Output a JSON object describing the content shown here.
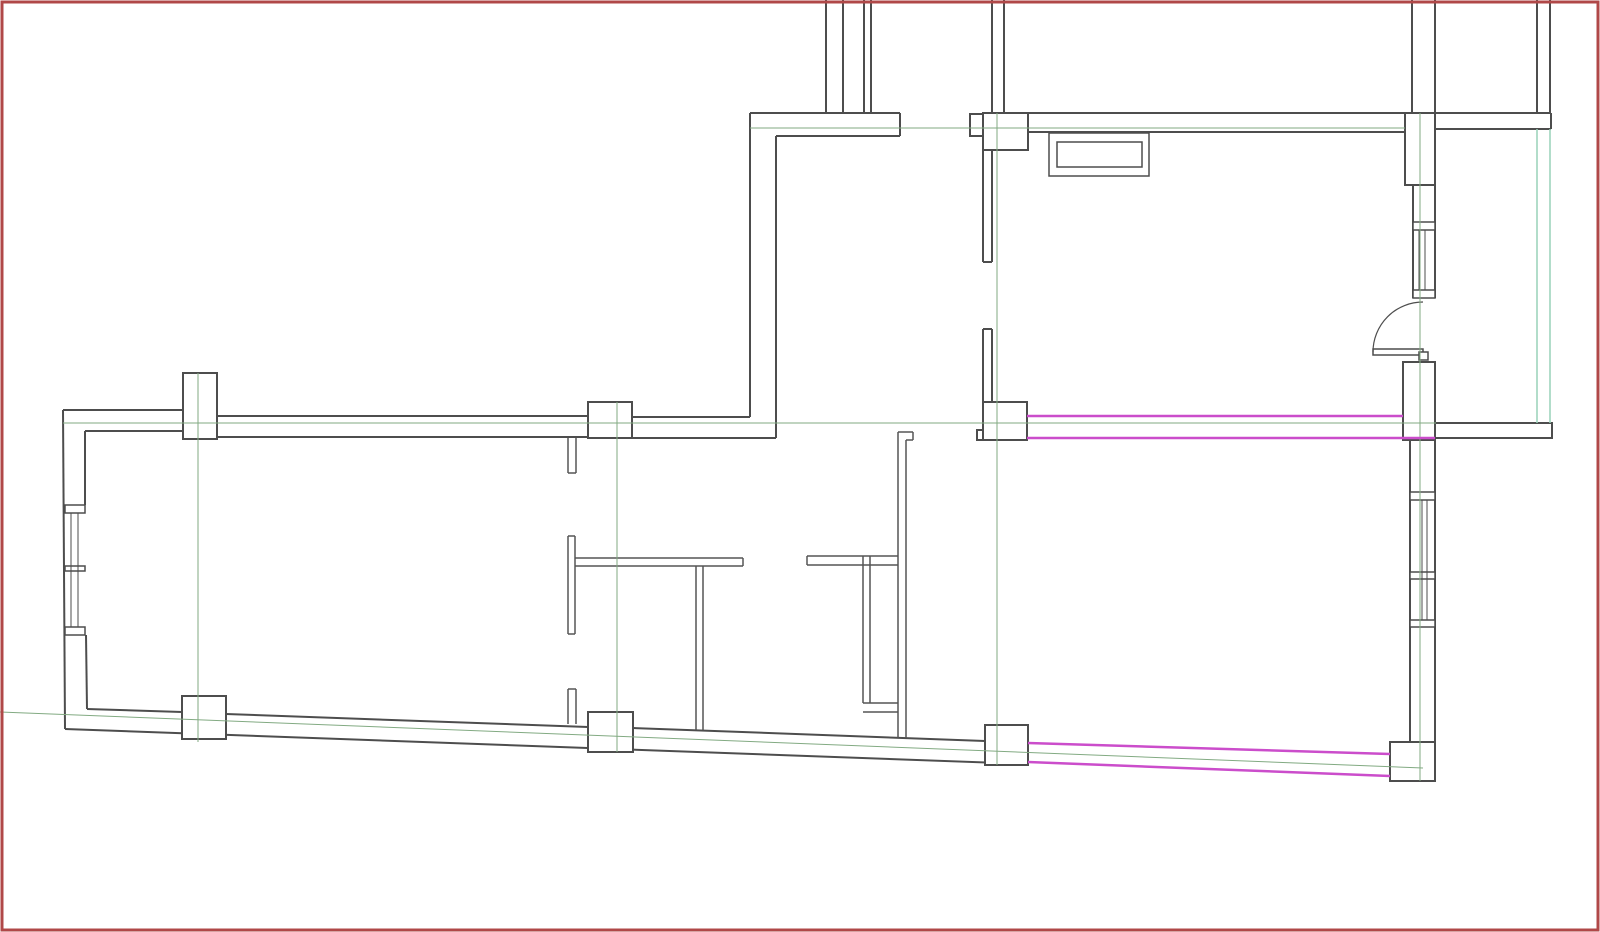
{
  "canvas": {
    "width": 1600,
    "height": 932,
    "background": "#ffffff"
  },
  "colors": {
    "wall": "#4d4d4d",
    "partition": "#555555",
    "green": "#82aa82",
    "teal": "#99d2b8",
    "magenta": "#cb4dcb",
    "border": "#b04848",
    "white": "#ffffff"
  },
  "layers": [
    {
      "name": "wall-line",
      "type": "line",
      "color": "wall",
      "width": 2,
      "items": [
        [
          63,
          410,
          183,
          410
        ],
        [
          217,
          416,
          588,
          416
        ],
        [
          632,
          417,
          750,
          417
        ],
        [
          85,
          431,
          183,
          431
        ],
        [
          217,
          437,
          588,
          437
        ],
        [
          632,
          438,
          776,
          438
        ],
        [
          63,
          410,
          65,
          729
        ],
        [
          85,
          431,
          85,
          505
        ],
        [
          86,
          635,
          87,
          709
        ],
        [
          65,
          729,
          1028,
          764
        ],
        [
          87,
          709,
          182,
          712
        ],
        [
          226,
          714,
          588,
          727
        ],
        [
          633,
          728,
          985,
          741
        ],
        [
          750,
          113,
          750,
          417
        ],
        [
          776,
          136,
          776,
          438
        ],
        [
          750,
          113,
          900,
          113
        ],
        [
          776,
          136,
          900,
          136
        ],
        [
          900,
          113,
          900,
          136
        ],
        [
          1028,
          113,
          1405,
          113
        ],
        [
          1028,
          132,
          1405,
          132
        ],
        [
          1435,
          113,
          1551,
          113
        ],
        [
          1435,
          129,
          1551,
          129
        ],
        [
          1551,
          113,
          1551,
          129
        ],
        [
          826,
          0,
          826,
          113
        ],
        [
          843,
          0,
          843,
          113
        ],
        [
          864,
          0,
          864,
          113
        ],
        [
          871,
          0,
          871,
          113
        ],
        [
          992,
          0,
          992,
          113
        ],
        [
          1004,
          0,
          1004,
          113
        ],
        [
          1412,
          0,
          1412,
          113
        ],
        [
          1435,
          0,
          1435,
          113
        ],
        [
          1537,
          0,
          1537,
          113
        ],
        [
          1550,
          0,
          1550,
          113
        ],
        [
          983,
          148,
          983,
          262
        ],
        [
          992,
          148,
          992,
          262
        ],
        [
          983,
          262,
          992,
          262
        ],
        [
          983,
          329,
          983,
          402
        ],
        [
          992,
          329,
          992,
          402
        ],
        [
          983,
          329,
          992,
          329
        ],
        [
          1413,
          185,
          1413,
          298
        ],
        [
          1435,
          185,
          1435,
          298
        ],
        [
          1410,
          440,
          1410,
          742
        ],
        [
          1435,
          440,
          1435,
          742
        ]
      ]
    },
    {
      "name": "partition-line",
      "type": "line",
      "color": "partition",
      "width": 1.5,
      "items": [
        [
          568,
          438,
          568,
          473
        ],
        [
          576,
          438,
          576,
          473
        ],
        [
          568,
          473,
          576,
          473
        ],
        [
          568,
          536,
          568,
          634
        ],
        [
          575,
          536,
          575,
          634
        ],
        [
          568,
          536,
          575,
          536
        ],
        [
          568,
          634,
          575,
          634
        ],
        [
          575,
          558,
          743,
          558
        ],
        [
          575,
          566,
          743,
          566
        ],
        [
          743,
          558,
          743,
          566
        ],
        [
          696,
          566,
          696,
          730
        ],
        [
          703,
          566,
          703,
          730
        ],
        [
          568,
          689,
          568,
          724
        ],
        [
          576,
          689,
          576,
          724
        ],
        [
          568,
          689,
          576,
          689
        ],
        [
          807,
          556,
          898,
          556
        ],
        [
          807,
          565,
          898,
          565
        ],
        [
          807,
          556,
          807,
          565
        ],
        [
          863,
          556,
          863,
          703
        ],
        [
          870,
          556,
          870,
          703
        ],
        [
          863,
          703,
          898,
          703
        ],
        [
          863,
          712,
          898,
          712
        ],
        [
          898,
          432,
          898,
          738
        ],
        [
          906,
          440,
          906,
          738
        ],
        [
          898,
          432,
          913,
          432
        ],
        [
          913,
          432,
          913,
          440
        ],
        [
          906,
          440,
          913,
          440
        ]
      ]
    },
    {
      "name": "column",
      "type": "rect",
      "color": "wall",
      "width": 2,
      "fill": "white",
      "items": [
        [
          970,
          114,
          13,
          22
        ],
        [
          977,
          430,
          6,
          10
        ],
        [
          183,
          373,
          34,
          66
        ],
        [
          588,
          402,
          44,
          36
        ],
        [
          983,
          113,
          45,
          37
        ],
        [
          1405,
          113,
          30,
          72
        ],
        [
          1403,
          362,
          32,
          78
        ],
        [
          983,
          402,
          44,
          38
        ],
        [
          182,
          696,
          44,
          43
        ],
        [
          588,
          712,
          45,
          40
        ],
        [
          985,
          725,
          43,
          40
        ],
        [
          1390,
          742,
          45,
          39
        ],
        [
          1435,
          423,
          117,
          15
        ]
      ]
    },
    {
      "name": "fixture-rect",
      "type": "rect",
      "color": "wall",
      "width": 1.5,
      "fill": "white",
      "items": [
        [
          1049,
          133,
          100,
          43
        ],
        [
          1057,
          142,
          85,
          25
        ],
        [
          65,
          505,
          20,
          8
        ],
        [
          65,
          566,
          20,
          5
        ],
        [
          65,
          627,
          20,
          8
        ],
        [
          1413,
          222,
          22,
          8
        ],
        [
          1413,
          290,
          22,
          8
        ],
        [
          1410,
          492,
          25,
          8
        ],
        [
          1410,
          572,
          25,
          7
        ],
        [
          1410,
          620,
          25,
          7
        ],
        [
          1373,
          349,
          50,
          6
        ],
        [
          1419,
          352,
          9,
          8
        ]
      ]
    },
    {
      "name": "window-pane-line",
      "type": "line",
      "color": "wall",
      "width": 1,
      "items": [
        [
          71,
          513,
          71,
          627
        ],
        [
          78,
          513,
          78,
          627
        ],
        [
          1419,
          230,
          1419,
          290
        ],
        [
          1425,
          230,
          1425,
          290
        ],
        [
          1422,
          500,
          1422,
          620
        ],
        [
          1427,
          500,
          1427,
          620
        ]
      ]
    },
    {
      "name": "door-swing-arc",
      "type": "path",
      "color": "wall",
      "width": 1.2,
      "items": [
        "M 1373 352 A 50 50 0 0 1 1423 302"
      ]
    },
    {
      "name": "grid-line-green",
      "type": "line",
      "color": "green",
      "width": 1,
      "items": [
        [
          750,
          128,
          1405,
          128
        ],
        [
          63,
          423,
          1436,
          423
        ],
        [
          0,
          712,
          1423,
          768
        ],
        [
          198,
          373,
          198,
          742
        ],
        [
          617,
          402,
          617,
          752
        ],
        [
          997,
          113,
          997,
          765
        ],
        [
          1420,
          113,
          1420,
          781
        ]
      ]
    },
    {
      "name": "grid-line-teal",
      "type": "line",
      "color": "teal",
      "width": 1.5,
      "items": [
        [
          1537,
          129,
          1537,
          423
        ],
        [
          1550,
          129,
          1550,
          423
        ]
      ]
    },
    {
      "name": "highlight-line-magenta",
      "type": "line",
      "color": "magenta",
      "width": 2.5,
      "items": [
        [
          1027,
          416,
          1403,
          416
        ],
        [
          1027,
          438,
          1435,
          438
        ],
        [
          1028,
          743,
          1390,
          754
        ],
        [
          1028,
          762,
          1390,
          776
        ]
      ]
    },
    {
      "name": "page-border",
      "type": "rect",
      "color": "border",
      "width": 3,
      "fill": "none",
      "items": [
        [
          2,
          2,
          1596,
          928
        ]
      ]
    }
  ]
}
